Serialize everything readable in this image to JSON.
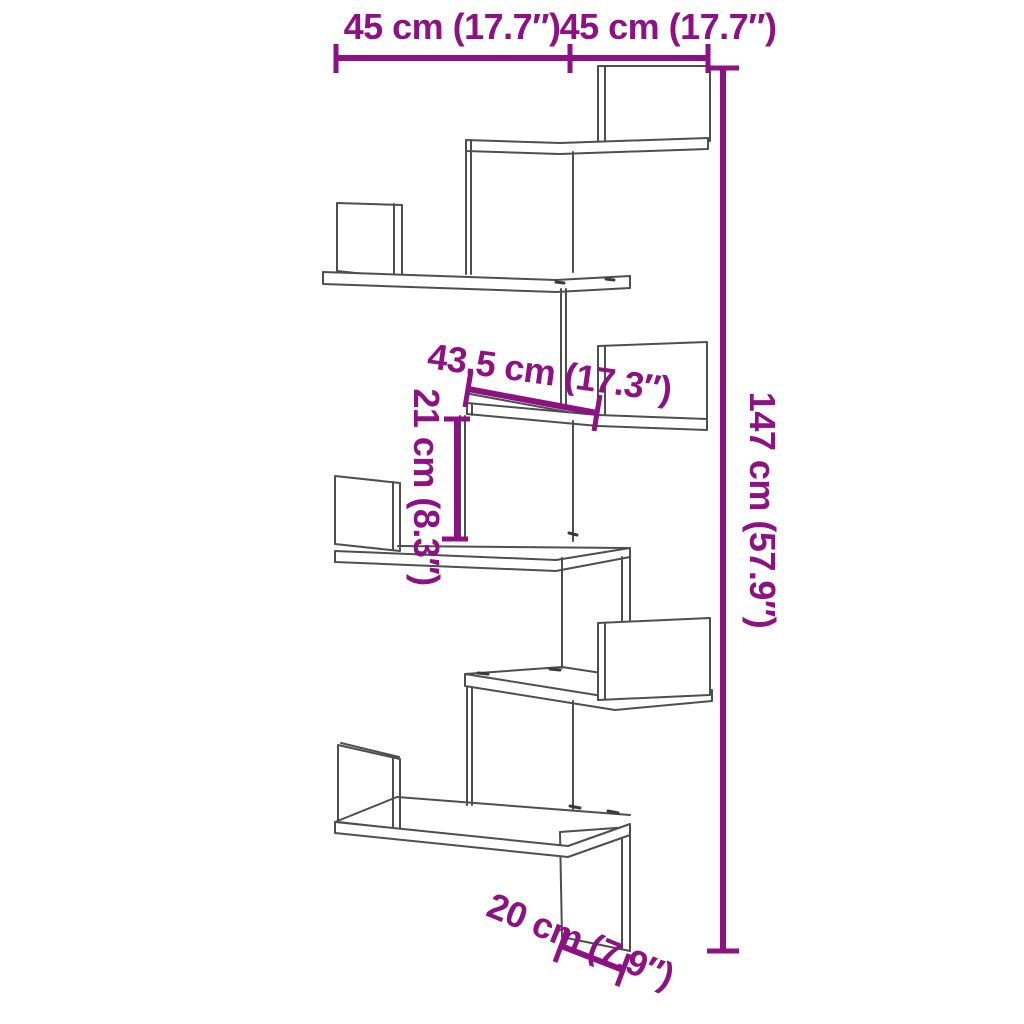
{
  "diagram": {
    "title": "Corner wall shelf dimension diagram",
    "colors": {
      "accent": "#8e1184",
      "line": "#4e4e4e",
      "background": "#ffffff"
    },
    "dimensions": {
      "top_width_left": "45 cm (17.7″)",
      "top_width_right": "45 cm (17.7″)",
      "height_total": "147 cm (57.9″)",
      "shelf_depth": "43,5 cm (17.3″)",
      "shelf_gap": "21 cm (8.3″)",
      "bottom_depth": "20 cm (7.9″)"
    }
  }
}
